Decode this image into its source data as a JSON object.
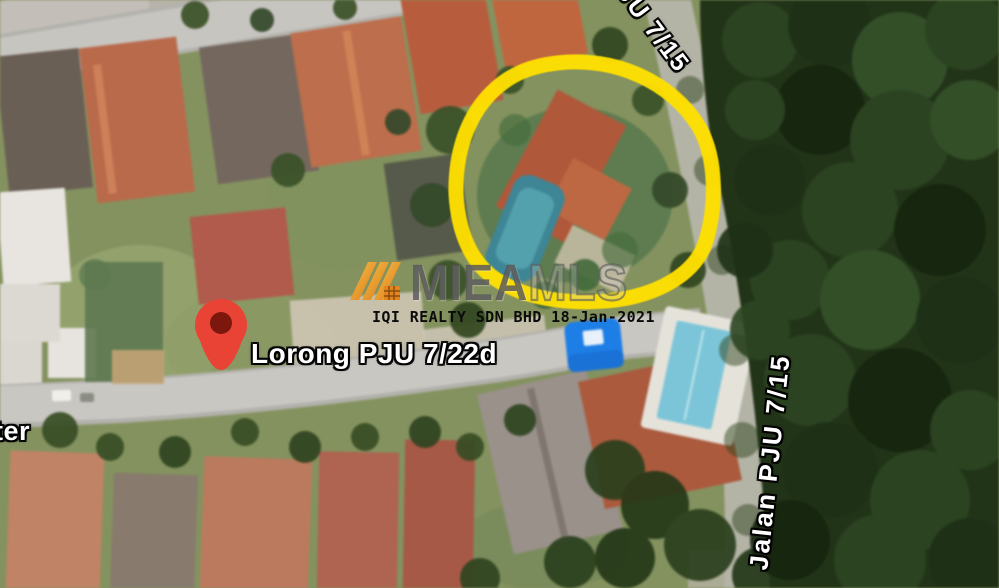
{
  "image": {
    "type": "satellite-map-listing-photo",
    "width": 999,
    "height": 588
  },
  "map_labels": {
    "street_pin_label": "Lorong PJU 7/22d",
    "road_label_right": "Jalan PJU 7/15",
    "road_label_top": "JU 7/15",
    "street_label_left_partial": "ter"
  },
  "marker": {
    "name": "red-map-pin",
    "color": "#E94335"
  },
  "annotation": {
    "name": "hand-drawn-property-circle",
    "color": "#FFE000"
  },
  "watermark": {
    "logo": "mieamls-logo",
    "brand_left": "MIEA",
    "brand_right": "MLS",
    "agency_line": "IQI REALTY SDN BHD 18-Jan-2021"
  },
  "colors": {
    "forest_green": "#223418",
    "grass_green": "#84925F",
    "road_gray": "#C9C7C2",
    "roof_orange": "#BD6B4A",
    "pool_teal": "#4E96A8",
    "annotation_yellow": "#FFE000",
    "pin_red": "#E94335",
    "tent_blue": "#1D7EE6"
  }
}
